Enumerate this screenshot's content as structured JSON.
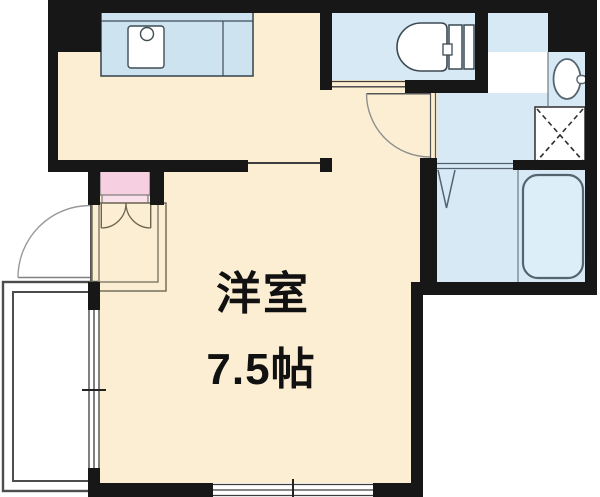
{
  "floor_plan": {
    "type": "japanese-apartment-floor-plan",
    "room": {
      "label": "洋室",
      "size": "7.5帖"
    },
    "fixtures": {
      "kitchen_counter": "kitchen-counter-with-sink",
      "kitchen_sink": "sink-basin-with-faucet",
      "toilet": "toilet-with-tank",
      "washbasin": "oval-washbasin-with-faucet",
      "washing_machine_space": "washing-machine-space-crossed-square",
      "bathtub": "bathtub",
      "closet": "closet-with-double-doors",
      "entrance_door": "outward-swing-entrance-door",
      "washroom_door": "inward-swing-door",
      "toilet_door": "sliding-door",
      "bathroom_door": "bifold-door",
      "windows": "sliding-windows",
      "balcony": "balcony"
    },
    "colors": {
      "wall": "#171717",
      "floor_cream": "#fbeed2",
      "water_blue": "#d6e9f4",
      "counter_blue": "#cde3f0",
      "bathtub_blue": "#dceef8",
      "closet_pink": "#f6cfe0",
      "closet_pink_light": "#f9e0eb",
      "fixture_white": "#ffffff"
    }
  }
}
